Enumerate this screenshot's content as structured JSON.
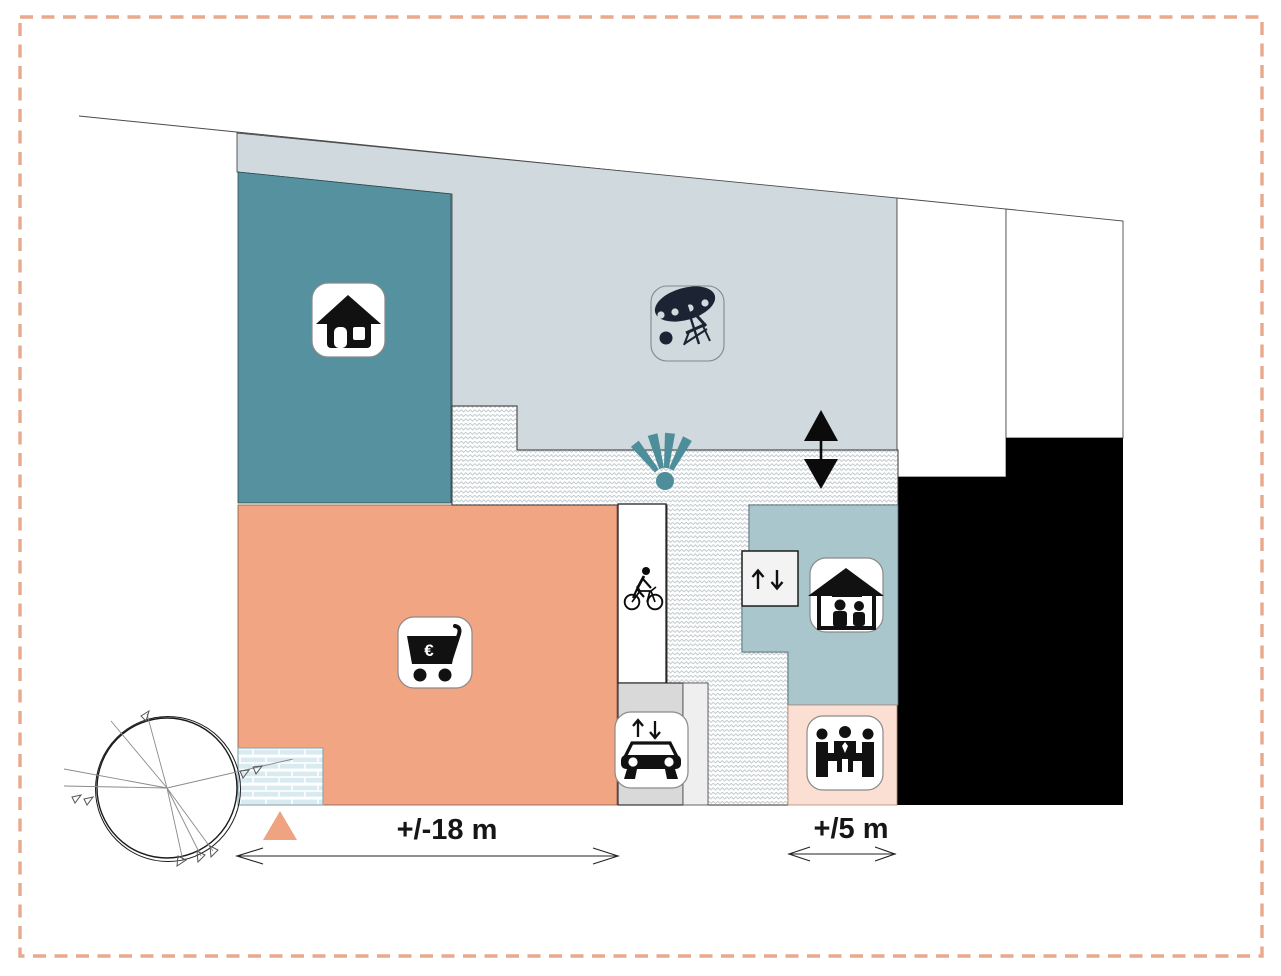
{
  "labels": {
    "main_width": "+/-18 m",
    "side_width": "+/5 m",
    "euro": "€"
  },
  "colors": {
    "zone_gray": "#D0D9DD",
    "zone_teal": "#55919E",
    "zone_salmon": "#F2A582",
    "zone_bluegray": "#A9C6CD",
    "zone_pink": "#FBDFD2",
    "zone_black": "#000000",
    "accent_salmon": "#EFA381",
    "fan_teal": "#4E8E9B",
    "border_dash": "#E8A98C",
    "icon_dark": "#111111",
    "beach_navy": "#1C2433"
  },
  "icons": [
    "house-icon",
    "beach-umbrella-icon",
    "shopping-cart-euro-icon",
    "cyclist-icon",
    "fan-icon",
    "vertical-double-arrow-icon",
    "updown-arrows-icon",
    "elevator-people-icon",
    "car-lift-icon",
    "meeting-people-icon",
    "north-triangle-marker",
    "wind-rose"
  ],
  "zones": [
    {
      "name": "upper-terrace-zone",
      "color": "#D0D9DD",
      "icon": "beach-umbrella-icon"
    },
    {
      "name": "housing-zone",
      "color": "#55919E",
      "icon": "house-icon"
    },
    {
      "name": "retail-zone",
      "color": "#F2A582",
      "icon": "shopping-cart-euro-icon"
    },
    {
      "name": "elevator-zone",
      "color": "#A9C6CD",
      "icon": "elevator-people-icon"
    },
    {
      "name": "meeting-zone",
      "color": "#FBDFD2",
      "icon": "meeting-people-icon"
    },
    {
      "name": "neighbour-building",
      "color": "#000000",
      "icon": null
    },
    {
      "name": "pedestrian-path",
      "pattern": "herringbone",
      "icon": null
    },
    {
      "name": "bike-lane",
      "color": "#FFFFFF",
      "icon": "cyclist-icon"
    },
    {
      "name": "car-ramp",
      "color": "#D9D9D9",
      "icon": "car-lift-icon"
    },
    {
      "name": "brick-entrance",
      "pattern": "brick",
      "icon": null
    }
  ],
  "measurements": {
    "site_width_m": "+/-18 m",
    "side_width_m": "+/5 m"
  }
}
